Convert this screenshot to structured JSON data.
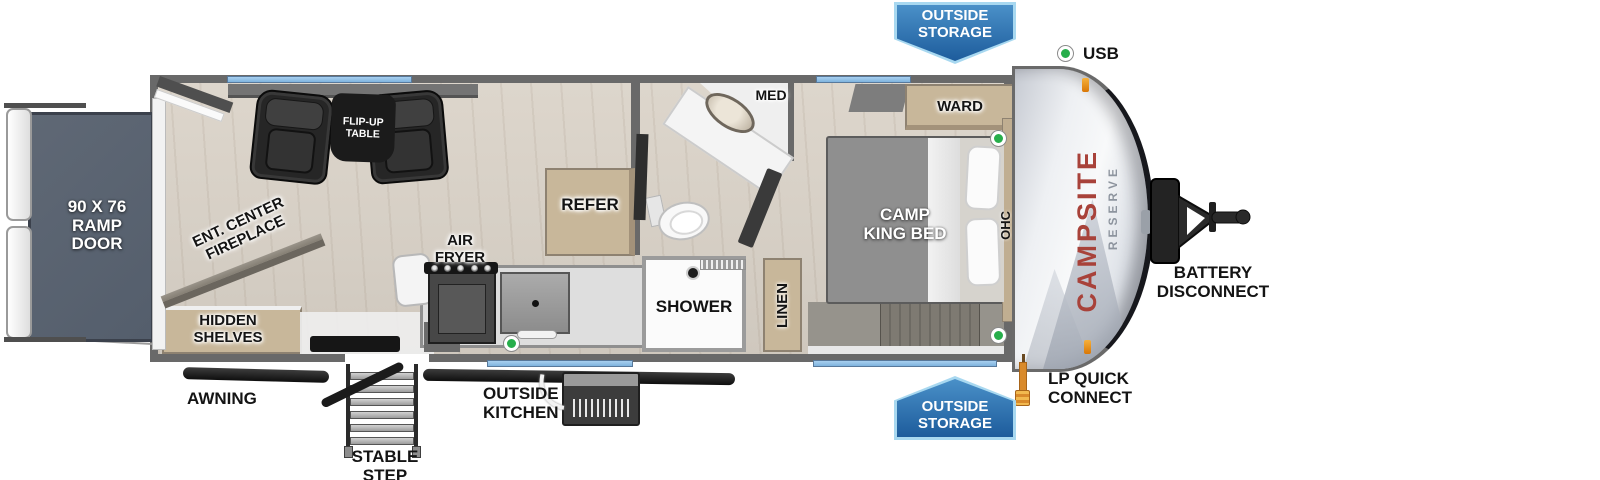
{
  "floorplan": {
    "brand": {
      "name": "CAMPSITE",
      "series": "RESERVE"
    },
    "rooms": {
      "ramp_door": {
        "line1": "90 X 76",
        "line2": "RAMP",
        "line3": "DOOR"
      },
      "flip_up_table": {
        "line1": "FLIP-UP",
        "line2": "TABLE"
      },
      "ent_center_fireplace": {
        "line1": "ENT. CENTER",
        "line2": "FIREPLACE"
      },
      "hidden_shelves": {
        "line1": "HIDDEN",
        "line2": "SHELVES"
      },
      "air_fryer": {
        "line1": "AIR",
        "line2": "FRYER"
      },
      "refer": "REFER",
      "shower": "SHOWER",
      "med": "MED",
      "linen": "LINEN",
      "camp_king_bed": {
        "line1": "CAMP",
        "line2": "KING BED"
      },
      "ward": "WARD",
      "ohc": "OHC"
    },
    "callouts": {
      "outside_storage_top": {
        "line1": "OUTSIDE",
        "line2": "STORAGE"
      },
      "outside_storage_bottom": {
        "line1": "OUTSIDE",
        "line2": "STORAGE"
      },
      "usb": "USB",
      "lp_quick_connect": {
        "line1": "LP QUICK",
        "line2": "CONNECT"
      },
      "battery_disconnect": {
        "line1": "BATTERY",
        "line2": "DISCONNECT"
      },
      "awning": "AWNING",
      "stable_step": "STABLE STEP",
      "outside_kitchen": {
        "line1": "OUTSIDE",
        "line2": "KITCHEN"
      }
    },
    "colors": {
      "badge_blue_top": "#4a90c8",
      "badge_blue_bottom": "#1d5c9c",
      "badge_border": "#a8d8f0",
      "usb_green": "#27ae4b",
      "brand_red": "#a8423a",
      "window_blue": "#8fc0e8",
      "wall_gray": "#696969",
      "cabinet_tan": "#c8b79a",
      "lp_orange": "#d98a2b"
    }
  }
}
